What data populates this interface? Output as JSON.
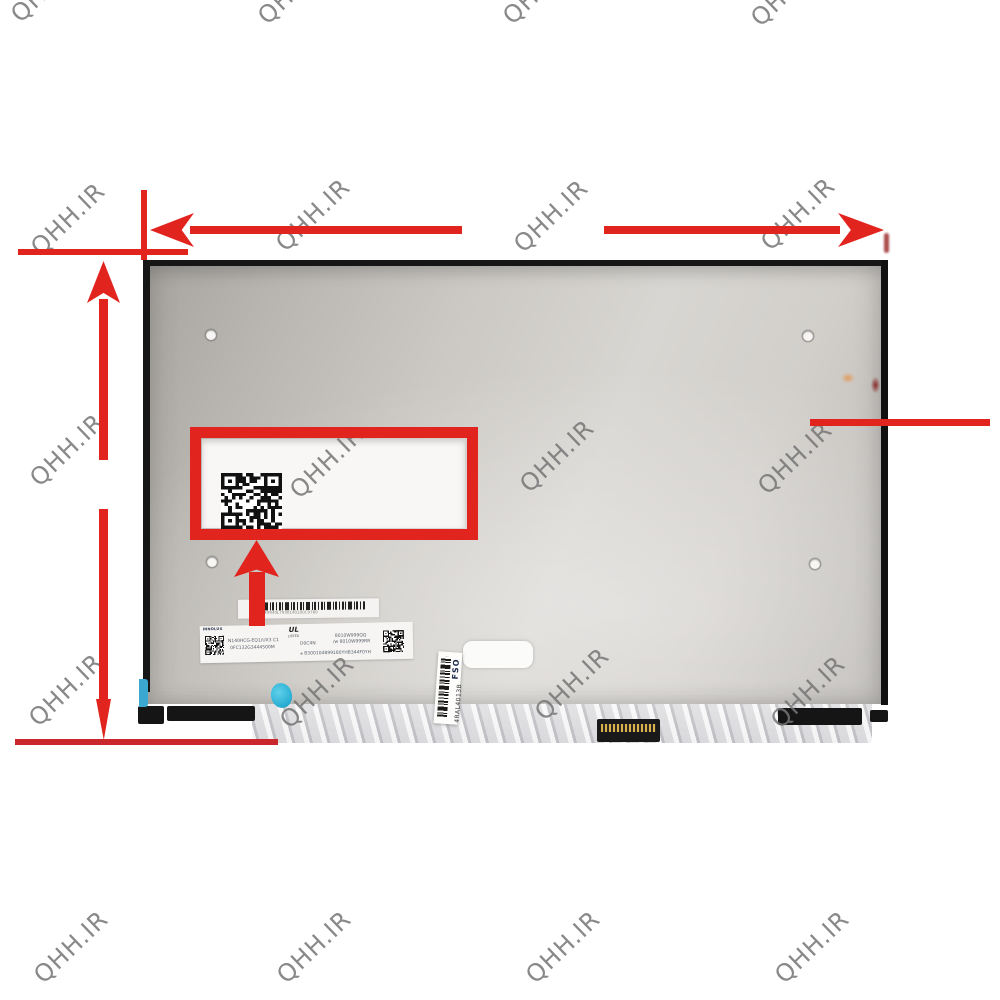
{
  "image_type": "watermarked product photo of a laptop LCD panel rear side with red dimension arrows and a highlighted QR-code area",
  "watermark": {
    "text": "QHH.IR",
    "color": "#757575",
    "positions": [
      [
        48,
        -14
      ],
      [
        295,
        -12
      ],
      [
        540,
        -12
      ],
      [
        788,
        -10
      ],
      [
        68,
        219
      ],
      [
        313,
        215
      ],
      [
        551,
        216
      ],
      [
        798,
        214
      ],
      [
        67,
        450
      ],
      [
        327,
        462
      ],
      [
        557,
        456
      ],
      [
        795,
        458
      ],
      [
        66,
        690
      ],
      [
        317,
        692
      ],
      [
        572,
        684
      ],
      [
        808,
        692
      ],
      [
        71,
        947
      ],
      [
        314,
        947
      ],
      [
        563,
        947
      ],
      [
        812,
        947
      ]
    ]
  },
  "annotations": {
    "accent_red": "#e2241f",
    "dark_red": "#c9272b"
  },
  "panel": {
    "bezel_color": "#161616",
    "body_color_left": "#a7a49f",
    "body_color_center": "#d8d6d2",
    "labels": {
      "barcode_strip": {
        "code": "EF0940L7930140100C9780"
      },
      "main_label": {
        "brand": "INNOLUX",
        "model": "N140HCG-EQ1/UX3 C1",
        "part_number": "0FC132G3444500M",
        "center_code": "D0C4N",
        "cert_mark": "UL",
        "cert_mark_sub": "LISTED",
        "cert_symbol": "⊕",
        "right_line1": "8010W999QQ",
        "right_line2": "/w 8010W999RR",
        "serial": "B300104899180YHB344F0YH"
      },
      "side_label": {
        "brand": "FSO",
        "code": "4RAL4013B"
      }
    }
  }
}
